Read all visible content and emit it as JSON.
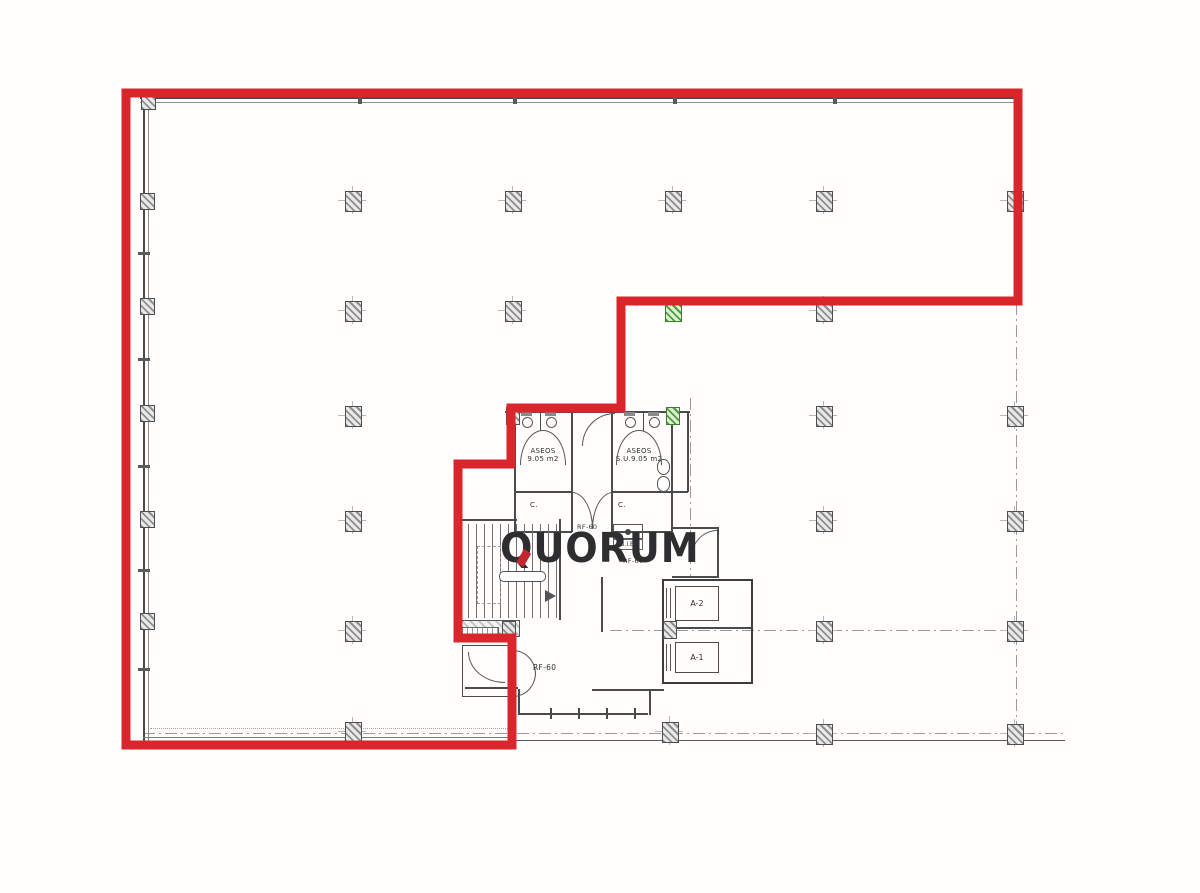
{
  "logo": {
    "text": "QUORUM"
  },
  "colors": {
    "boundary_red": "#d9262c",
    "wall_gray": "#4b4b4b",
    "column_green": "#4f9c3c",
    "logo_dark": "#2e2e31",
    "logo_red": "#c4272e"
  },
  "plan": {
    "labels": {
      "aseos_left_line1": "ASEOS",
      "aseos_left_line2": "9.05 m2",
      "aseos_right_line1": "ASEOS",
      "aseos_right_line2": "S.U.9.05 m2",
      "closet_left": "C.",
      "closet_right": "C.",
      "rf60_top": "RF-60",
      "bie": "B.I.E.",
      "rf60_mid": "RF-60",
      "rf60_bottom": "RF-60",
      "elevator_a2": "A-2",
      "elevator_a1": "A-1"
    }
  },
  "structure": {
    "outline": {
      "stroke_width": 9,
      "points": [
        [
          126,
          93
        ],
        [
          1018,
          93
        ],
        [
          1018,
          301
        ],
        [
          621,
          301
        ],
        [
          621,
          408
        ],
        [
          511,
          408
        ],
        [
          511,
          464
        ],
        [
          458,
          464
        ],
        [
          458,
          638
        ],
        [
          512,
          638
        ],
        [
          512,
          745
        ],
        [
          126,
          745
        ]
      ]
    },
    "columns": [
      {
        "x": 147,
        "y": 100,
        "variant": "wall"
      },
      {
        "x": 146,
        "y": 200,
        "variant": "wall"
      },
      {
        "x": 146,
        "y": 305,
        "variant": "wall"
      },
      {
        "x": 146,
        "y": 412,
        "variant": "wall"
      },
      {
        "x": 146,
        "y": 518,
        "variant": "wall"
      },
      {
        "x": 146,
        "y": 620,
        "variant": "wall"
      },
      {
        "x": 352,
        "y": 200
      },
      {
        "x": 512,
        "y": 200
      },
      {
        "x": 672,
        "y": 200
      },
      {
        "x": 823,
        "y": 200
      },
      {
        "x": 1014,
        "y": 200
      },
      {
        "x": 352,
        "y": 310
      },
      {
        "x": 512,
        "y": 310
      },
      {
        "x": 672,
        "y": 310,
        "variant": "green"
      },
      {
        "x": 823,
        "y": 310
      },
      {
        "x": 352,
        "y": 415
      },
      {
        "x": 823,
        "y": 415
      },
      {
        "x": 1014,
        "y": 415
      },
      {
        "x": 512,
        "y": 415,
        "variant": "small"
      },
      {
        "x": 672,
        "y": 415,
        "variant": "green-small"
      },
      {
        "x": 352,
        "y": 520
      },
      {
        "x": 823,
        "y": 520
      },
      {
        "x": 1014,
        "y": 520
      },
      {
        "x": 352,
        "y": 630
      },
      {
        "x": 823,
        "y": 630
      },
      {
        "x": 1014,
        "y": 630
      },
      {
        "x": 508,
        "y": 629,
        "variant": "small"
      },
      {
        "x": 669,
        "y": 629,
        "variant": "small"
      },
      {
        "x": 352,
        "y": 731
      },
      {
        "x": 669,
        "y": 731
      },
      {
        "x": 823,
        "y": 733
      },
      {
        "x": 1014,
        "y": 733
      }
    ],
    "walls": [
      [
        505,
        411,
        185,
        2
      ],
      [
        515,
        491,
        57,
        1.5
      ],
      [
        612,
        491,
        76,
        1.5
      ],
      [
        515,
        531,
        57,
        1.5
      ],
      [
        612,
        531,
        60,
        1.5
      ],
      [
        457,
        519,
        60,
        2
      ],
      [
        672,
        527,
        46,
        1.5
      ],
      [
        672,
        576,
        46,
        1.5
      ],
      [
        592,
        689,
        72,
        2
      ],
      [
        465,
        687,
        53,
        1.5
      ],
      [
        520,
        713,
        128,
        2
      ],
      [
        514,
        411,
        1.5,
        121
      ],
      [
        571,
        411,
        1.5,
        121
      ],
      [
        611,
        411,
        1.5,
        121
      ],
      [
        671,
        411,
        1.5,
        121
      ],
      [
        687,
        411,
        1.5,
        81
      ],
      [
        717,
        527,
        1.5,
        51
      ],
      [
        559,
        519,
        1.5,
        101
      ],
      [
        649,
        689,
        1.5,
        26
      ],
      [
        518,
        689,
        1.5,
        26
      ],
      [
        601,
        577,
        1.5,
        55
      ],
      [
        540,
        411,
        1,
        20
      ],
      [
        643,
        411,
        1,
        20
      ],
      [
        662,
        627,
        91,
        2
      ]
    ],
    "mullions": {
      "y": 708,
      "xs": [
        550,
        578,
        606,
        634
      ]
    },
    "wall_ticks": {
      "top_xs": [
        360,
        515,
        675,
        835
      ],
      "left_ys": [
        252,
        358,
        465,
        569,
        668
      ]
    }
  }
}
